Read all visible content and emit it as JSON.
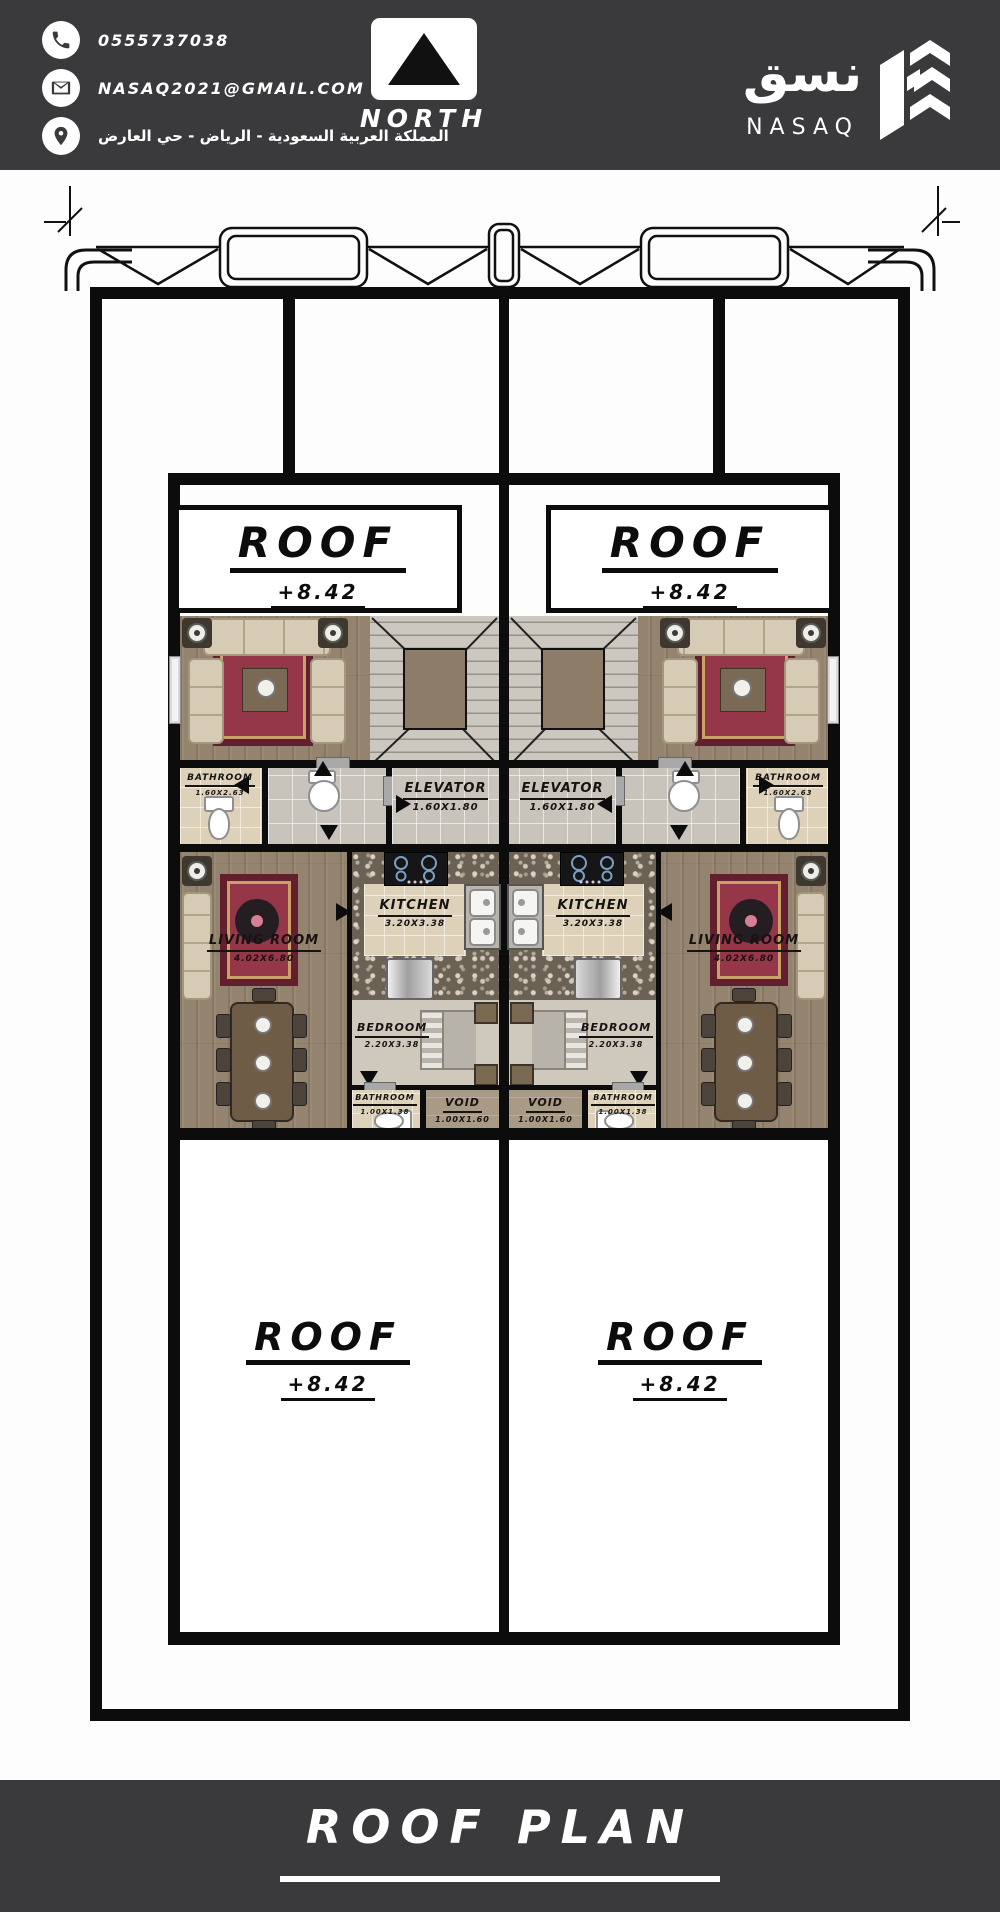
{
  "header": {
    "phone": "0555737038",
    "email": "NASAQ2021@GMAIL.COM",
    "address_ar": "المملكة العربية السعودية - الرياض - حي العارض",
    "north_label": "NORTH",
    "logo_ar": "نسق",
    "logo_en": "NASAQ"
  },
  "plan": {
    "roof_label": "ROOF",
    "roof_level": "+8.42",
    "rooms": {
      "living1": {
        "name": "LIVING ROOM",
        "dims": "3.40X4.40"
      },
      "bathroom1": {
        "name": "BATHROOM",
        "dims": "1.60X2.63"
      },
      "elevator": {
        "name": "ELEVATOR",
        "dims": "1.60X1.80"
      },
      "kitchen": {
        "name": "KITCHEN",
        "dims": "3.20X3.38"
      },
      "living2": {
        "name": "LIVING ROOM",
        "dims": "4.02X6.80"
      },
      "bedroom": {
        "name": "BEDROOM",
        "dims": "2.20X3.38"
      },
      "bathroom2": {
        "name": "BATHROOM",
        "dims": "1.00X1.38"
      },
      "void": {
        "name": "VOID",
        "dims": "1.00X1.60"
      }
    }
  },
  "footer": {
    "title": "ROOF PLAN"
  },
  "colors": {
    "accent_dark": "#3a393c",
    "wall": "#0c0c0c",
    "rug": "#953649"
  }
}
